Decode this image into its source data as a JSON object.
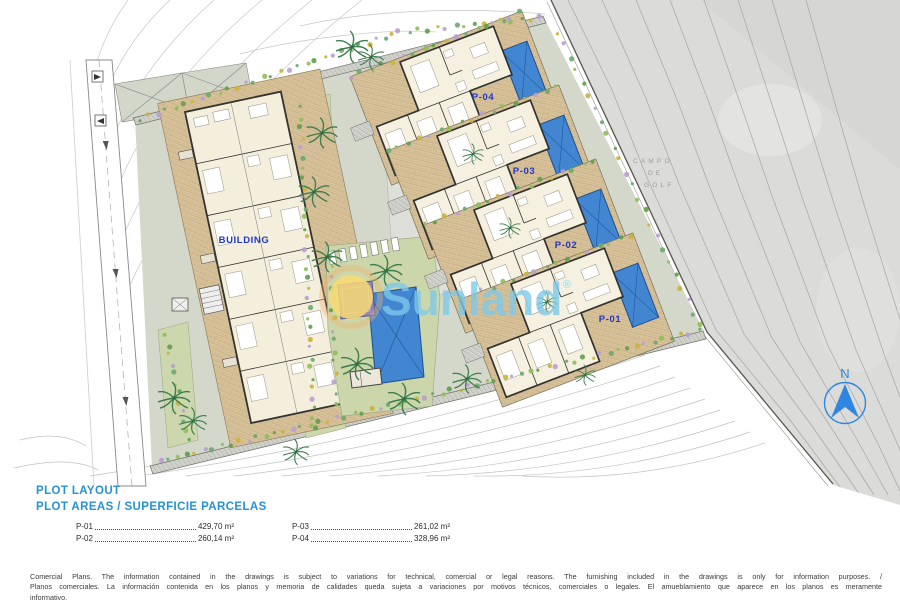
{
  "plan": {
    "building_label": "BUILDING",
    "villas": [
      {
        "label": "P-04"
      },
      {
        "label": "P-03"
      },
      {
        "label": "P-02"
      },
      {
        "label": "P-01"
      }
    ],
    "golf_lines": [
      "CAMPO",
      "DE",
      "GOLF"
    ],
    "north_label": "N"
  },
  "watermark": {
    "text": "Sunland",
    "reg": "®"
  },
  "legend": {
    "title_line1": "PLOT LAYOUT",
    "title_line2": "PLOT AREAS / SUPERFICIE PARCELAS",
    "plots": [
      {
        "name": "P-01",
        "area": "429,70 m²"
      },
      {
        "name": "P-02",
        "area": "260,14 m²"
      },
      {
        "name": "P-03",
        "area": "261,02 m²"
      },
      {
        "name": "P-04",
        "area": "328,96 m²"
      }
    ]
  },
  "disclaimer": {
    "line1": "Comercial Plans. The information contained in the drawings is subject to variations for technical, comercial or legal reasons. The furnishing included in the drawings is only for information purposes. /",
    "line2": "Planos comerciales. La información contenida en los planos y memoria de calidades queda sujeta a variaciones por motivos técnicos, comerciales o legales. El amueblamiento que aparece en los planos es meramente",
    "line3": "informativo."
  },
  "colors": {
    "legend_blue": "#2592d3",
    "label_blue": "#2336c4",
    "pool_blue": "#4286d2",
    "kids_pool_purple": "#9187bb",
    "terrace_tan": "#d9c49d",
    "parcel_green_gray": "#d4d8ca",
    "lawn_green": "#cbd6ab",
    "golf_gray": "#dbdbd9",
    "north_blue": "#2f86e0",
    "watermark_blue": "#7dc9e9",
    "watermark_sun_yellow": "#f8d973"
  }
}
